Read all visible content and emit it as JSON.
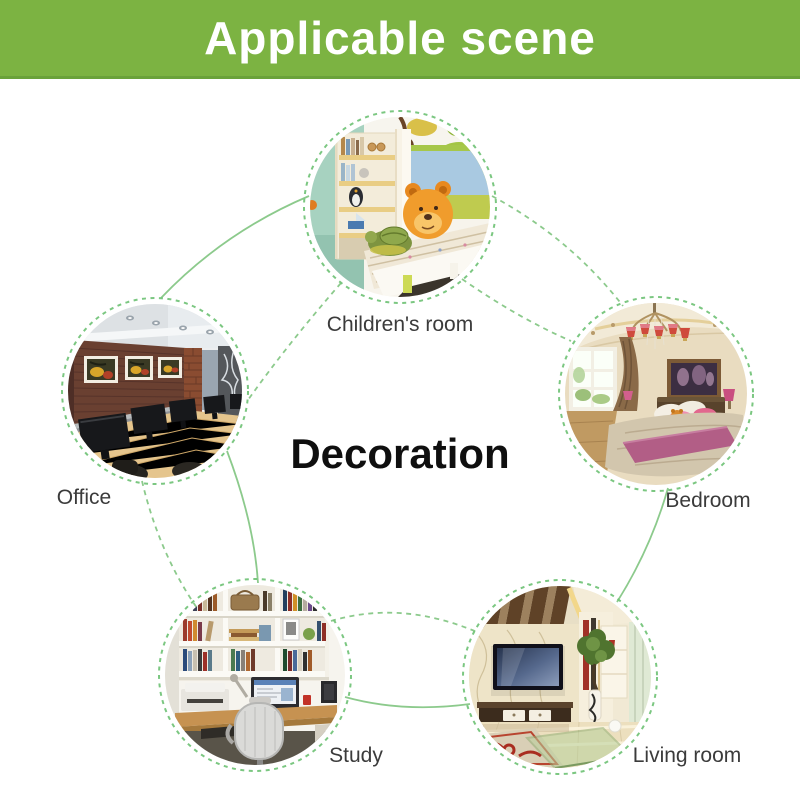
{
  "header": {
    "title": "Applicable scene",
    "bg_color": "#7cb342",
    "text_color": "#ffffff"
  },
  "center": {
    "label": "Decoration",
    "color": "#0f0f0f"
  },
  "theme": {
    "ring_color": "#74c47a",
    "connector_color": "#8cca8c",
    "label_color": "#3b3b3b",
    "background_color": "#ffffff"
  },
  "scenes": [
    {
      "id": "children-room",
      "label": "Children's room"
    },
    {
      "id": "office",
      "label": "Office"
    },
    {
      "id": "bedroom",
      "label": "Bedroom"
    },
    {
      "id": "study",
      "label": "Study"
    },
    {
      "id": "living-room",
      "label": "Living room"
    }
  ]
}
